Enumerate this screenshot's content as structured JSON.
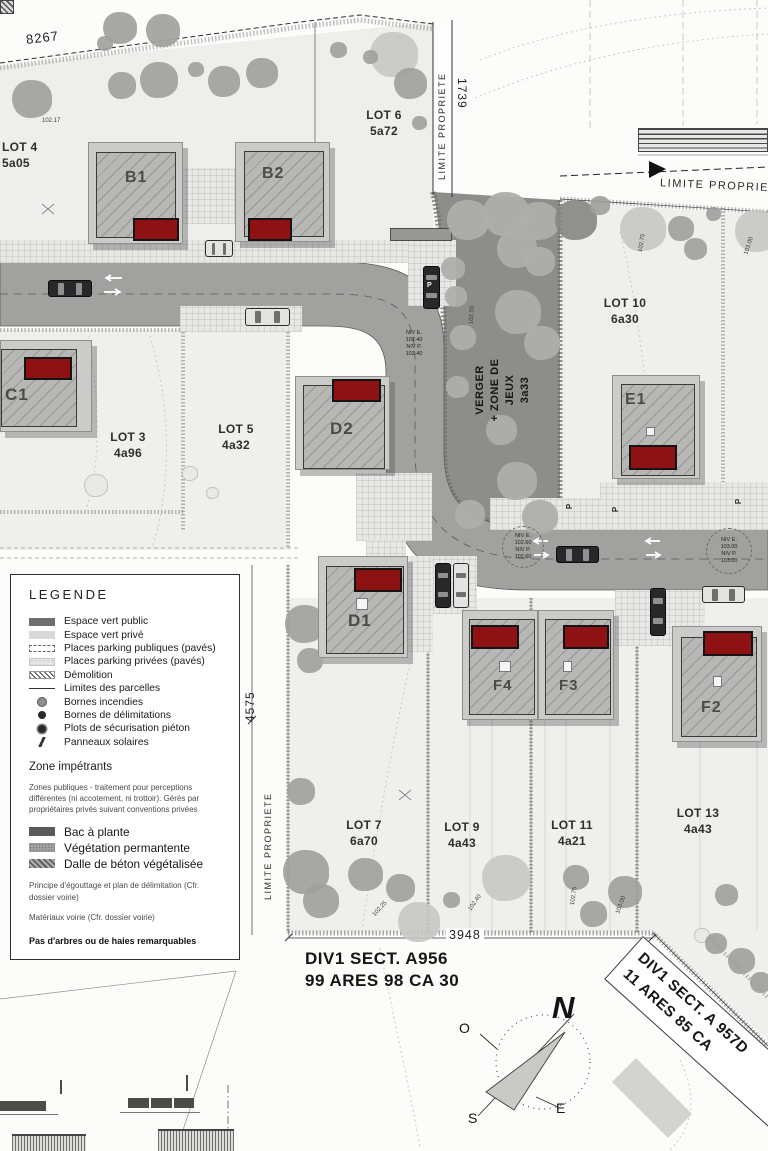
{
  "map": {
    "boundary_label": "LIMITE PROPRIETE",
    "dim_top": "8267",
    "dim_right": "1739",
    "dim_left": "4575",
    "dim_bottom": "3948",
    "parking_letter": "P",
    "verger_label": "VERGER\n+ ZONE DE\nJEUX\n3a33",
    "lots": {
      "lot4": {
        "name": "LOT 4",
        "area": "5a05"
      },
      "lot6": {
        "name": "LOT 6",
        "area": "5a72"
      },
      "lot10": {
        "name": "LOT 10",
        "area": "6a30"
      },
      "lot3": {
        "name": "LOT 3",
        "area": "4a96"
      },
      "lot5": {
        "name": "LOT 5",
        "area": "4a32"
      },
      "lot7": {
        "name": "LOT 7",
        "area": "6a70"
      },
      "lot9": {
        "name": "LOT 9",
        "area": "4a43"
      },
      "lot11": {
        "name": "LOT 11",
        "area": "4a21"
      },
      "lot13": {
        "name": "LOT 13",
        "area": "4a43"
      }
    },
    "buildings": {
      "b1": "B1",
      "b2": "B2",
      "c1": "C1",
      "d1": "D1",
      "d2": "D2",
      "e1": "E1",
      "f2": "F2",
      "f3": "F3",
      "f4": "F4"
    },
    "levels": {
      "curve": "NIV E.\n102.40\nNIV P.\n102.40",
      "road_left": "NIV E.\n102.60\nNIV P.\n102.60",
      "road_right": "NIV E.\n103.00\nNIV P.\n103.00"
    },
    "spot_elevations": {
      "e1": "102.50",
      "e2": "102.75",
      "e3": "103.00",
      "e4": "102.75",
      "e5": "103.00",
      "e6": "102.40",
      "e7": "102.25",
      "e8": "102.17"
    }
  },
  "legend": {
    "title": "LEGENDE",
    "items": [
      "Espace vert public",
      "Espace vert privé",
      "Places parking publiques (pavés)",
      "Places parking privées (pavés)",
      "Démolition",
      "Limites des parcelles",
      "Bornes incendies",
      "Bornes de délimitations",
      "Plots de sécurisation piéton",
      "Panneaux solaires"
    ],
    "zone_title": "Zone impétrants",
    "zone_note": "Zones publiques - traitement pour perceptions différentes (ni accotement, ni trottoir). Gérés par propriétaires privés suivant conventions privées",
    "zone_items": [
      "Bac à plante",
      "Végétation permantente",
      "Dalle de béton végétalisée"
    ],
    "note_drainage": "Principe d'égouttage et plan de délimitation (Cfr. dossier voirie)",
    "note_materials": "Matériaux voirie (Cfr. dossier voirie)",
    "note_trees": "Pas d'arbres ou de haies remarquables"
  },
  "sections": {
    "div1_line1": "DIV1 SECT. A956",
    "div1_line2": "99 ARES 98 CA 30",
    "div2_line1": "DIV1 SECT. A 957D",
    "div2_line2": "11 ARES 85 CA"
  },
  "compass": {
    "north": "N",
    "west": "O",
    "south": "S",
    "east": "E"
  }
}
